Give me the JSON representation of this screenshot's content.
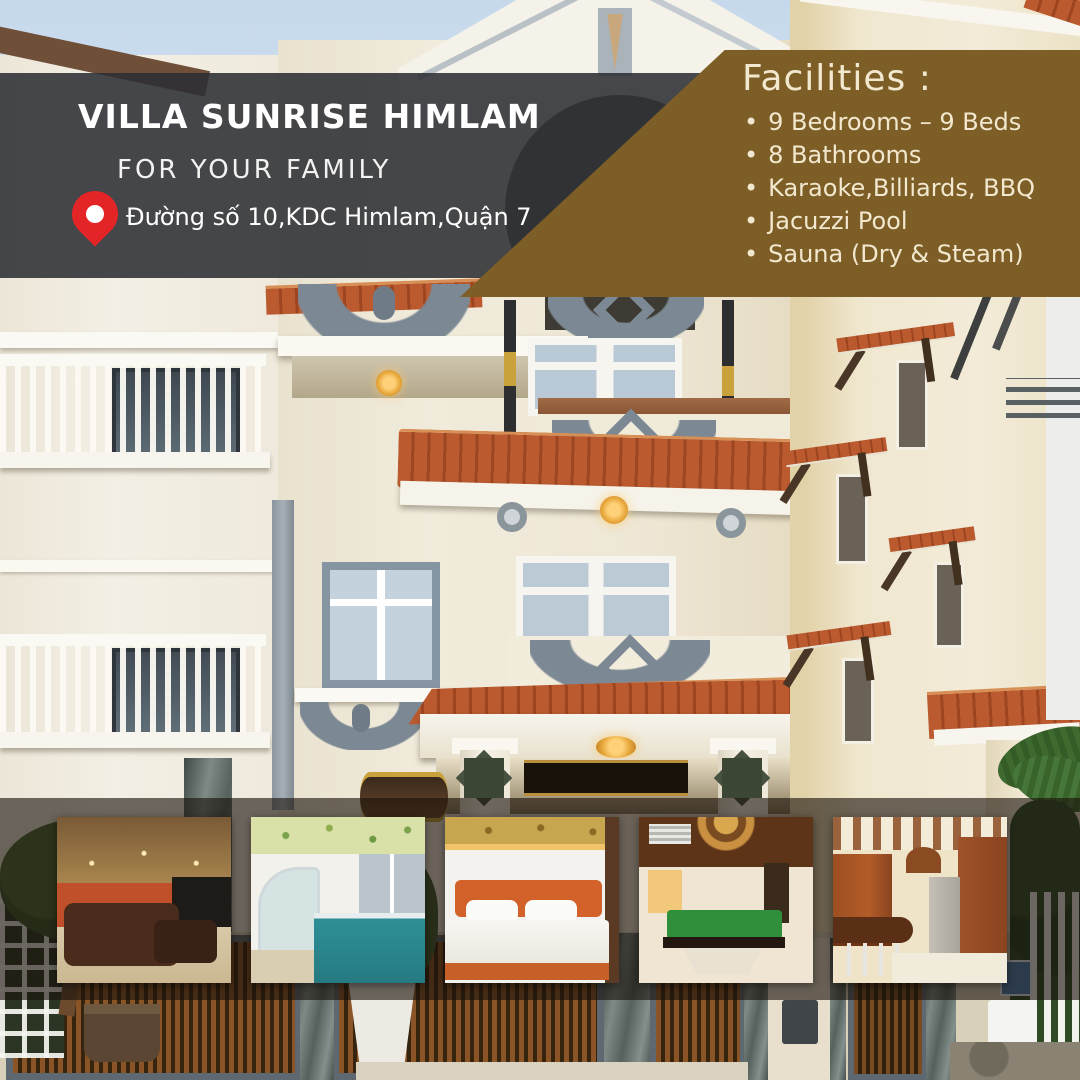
{
  "poster": {
    "header": {
      "title": "VILLA SUNRISE HIMLAM",
      "subtitle": "FOR YOUR FAMILY",
      "address": "Đường số 10,KDC Himlam,Quận 7"
    },
    "facilities": {
      "heading": "Facilities :",
      "bullet": "•",
      "items": [
        "9 Bedrooms – 9 Beds",
        "8 Bathrooms",
        "Karaoke,Billiards, BBQ",
        "Jacuzzi Pool",
        "Sauna (Dry & Steam)"
      ]
    },
    "colors": {
      "banner_dark": "#2c2f33",
      "banner_brown": "#7d5e26",
      "facilities_text": "#f2e8cf",
      "pin_red": "#e42528"
    },
    "thumbnails": [
      {
        "subject": "karaoke lounge room"
      },
      {
        "subject": "indoor jacuzzi pool"
      },
      {
        "subject": "bedroom with orange bed"
      },
      {
        "subject": "billiards room"
      },
      {
        "subject": "wooden kitchen"
      }
    ]
  }
}
